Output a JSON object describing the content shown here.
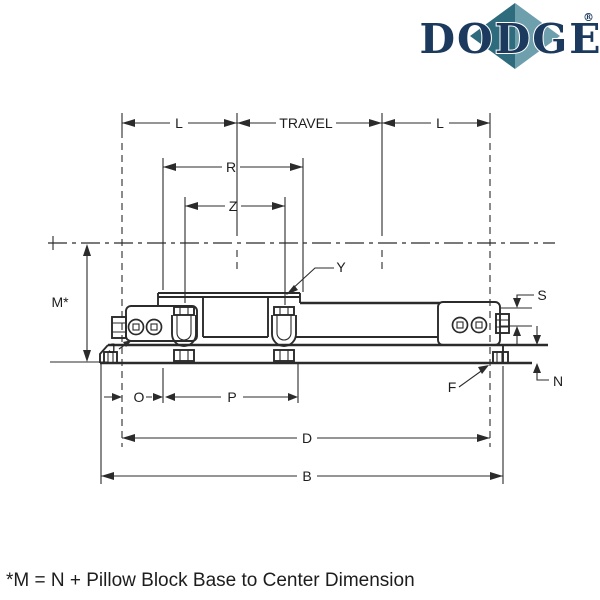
{
  "logo": {
    "text": "DODGE",
    "registered": "®"
  },
  "footnote": "*M = N + Pillow Block Base to Center Dimension",
  "colors": {
    "line": "#2b2b2b",
    "logo_navy": "#1b3a5e",
    "diamond_dark": "#2e6b7d",
    "diamond_light": "#6e9fad"
  },
  "dimensions": {
    "l_left": "L",
    "travel": "TRAVEL",
    "l_right": "L",
    "r": "R",
    "z": "Z",
    "y": "Y",
    "m": "M*",
    "s": "S",
    "n": "N",
    "f": "F",
    "j": "J",
    "o": "O",
    "p": "P",
    "d": "D",
    "b": "B"
  }
}
